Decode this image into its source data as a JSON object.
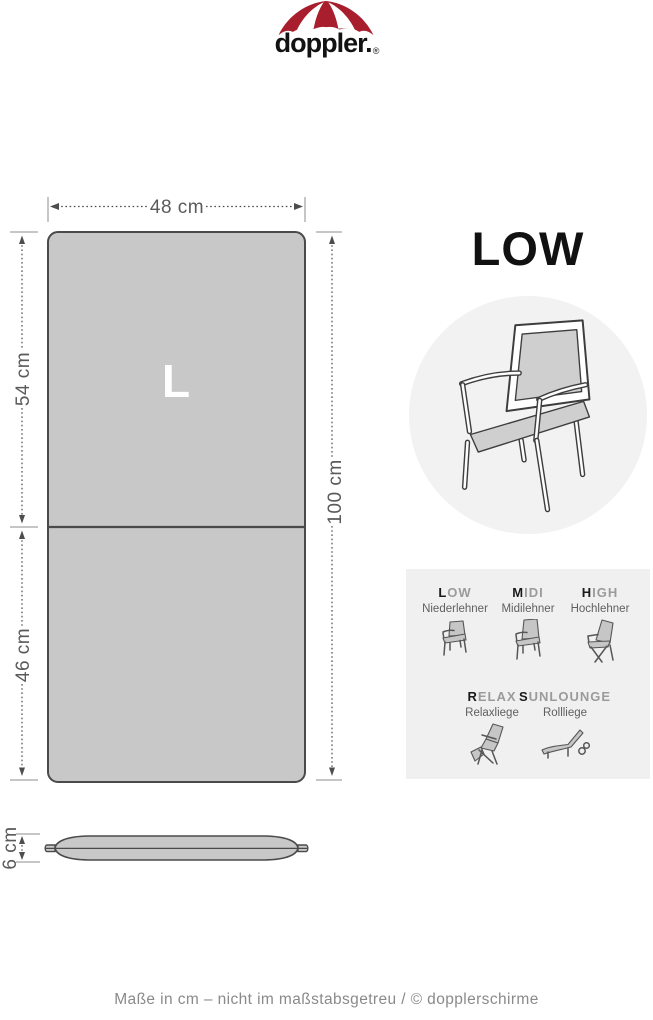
{
  "brand": {
    "wordmark": "doppler.",
    "registered": "®",
    "umbrella_icon": "doppler-umbrella",
    "red": "#a81e2d"
  },
  "diagram": {
    "size_label": "L",
    "width_label": "48 cm",
    "top_section_label": "54 cm",
    "bottom_section_label": "46 cm",
    "total_height_label": "100 cm",
    "thickness_label": "6 cm",
    "cushion_fill": "#c8c8c8",
    "outline_color": "#4a4a4a"
  },
  "type": {
    "title": "LOW",
    "chair_icon": "low-back-armchair",
    "circle_bg": "#f2f2f2"
  },
  "matrix": {
    "panel_bg": "#f0f0f0",
    "items": [
      {
        "code_first": "L",
        "code_rest": "OW",
        "name": "Niederlehner",
        "icon": "chair-low-icon"
      },
      {
        "code_first": "M",
        "code_rest": "IDI",
        "name": "Midilehner",
        "icon": "chair-midi-icon"
      },
      {
        "code_first": "H",
        "code_rest": "IGH",
        "name": "Hochlehner",
        "icon": "chair-high-icon"
      },
      {
        "code_first": "R",
        "code_rest": "ELAX",
        "name": "Relaxliege",
        "icon": "chair-relax-icon"
      },
      {
        "code_first": "S",
        "code_rest": "UNLOUNGE",
        "name": "Rollliege",
        "icon": "sunlounger-icon"
      }
    ]
  },
  "footer": {
    "note": "Maße in cm – nicht im maßstabsgetreu  / © dopplerschirme"
  }
}
